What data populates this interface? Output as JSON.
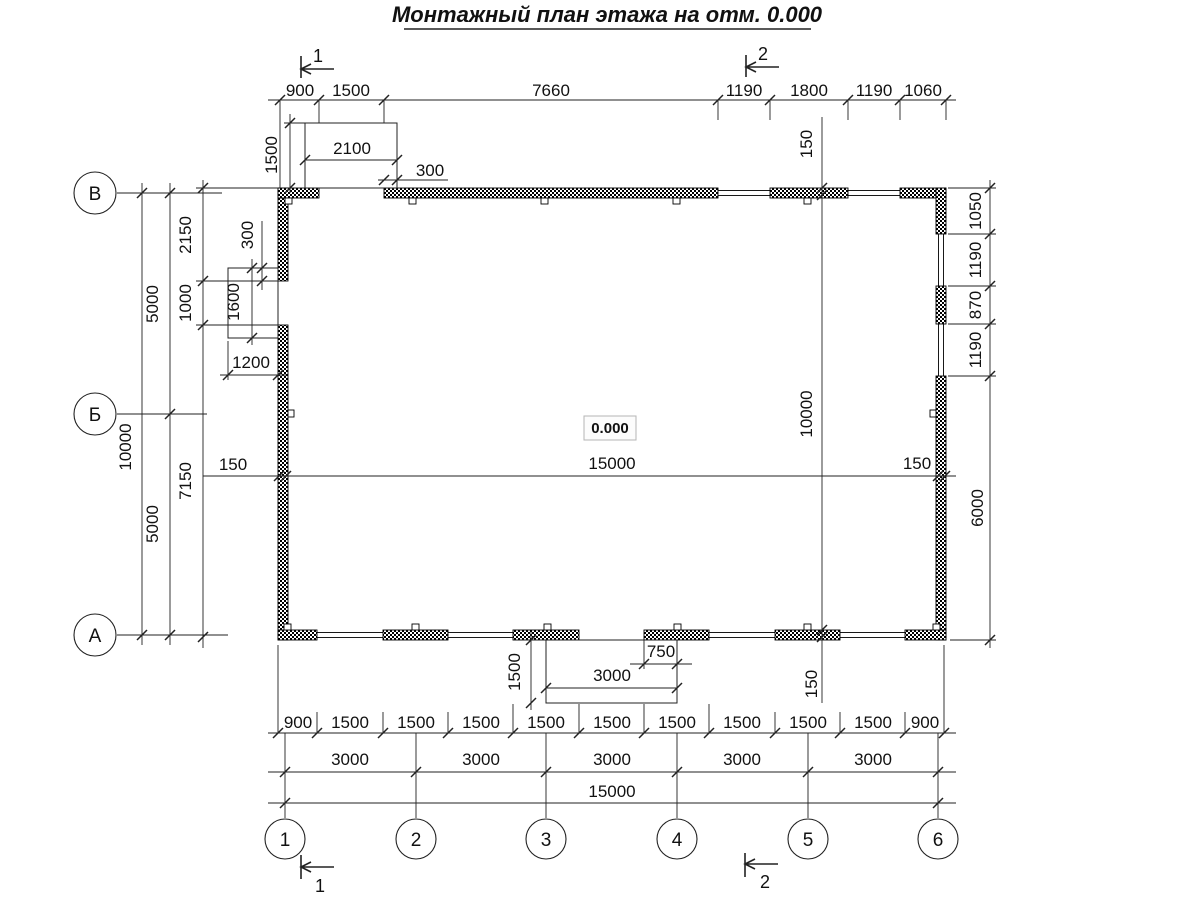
{
  "title": "Монтажный план этажа на отм. 0.000",
  "elevation_mark": "0.000",
  "axes": {
    "left": [
      "В",
      "Б",
      "А"
    ],
    "bottom": [
      "1",
      "2",
      "3",
      "4",
      "5",
      "6"
    ]
  },
  "section_marks": {
    "m1": "1",
    "m2": "2"
  },
  "dims": {
    "top": [
      "900",
      "1500",
      "7660",
      "1190",
      "1800",
      "1190",
      "1060"
    ],
    "top_porch": [
      "2100",
      "1500",
      "300"
    ],
    "left": [
      "10000",
      "5000",
      "5000",
      "2150",
      "1000",
      "7150"
    ],
    "left_porch": [
      "300",
      "1600",
      "1200"
    ],
    "mid_h": [
      "150",
      "15000",
      "150"
    ],
    "mid_v": [
      "150",
      "10000",
      "150"
    ],
    "right": [
      "1050",
      "1190",
      "870",
      "1190",
      "6000"
    ],
    "bottom_porch": [
      "1500",
      "750",
      "3000"
    ],
    "row1": [
      "900",
      "1500",
      "1500",
      "1500",
      "1500",
      "1500",
      "1500",
      "1500",
      "1500",
      "1500",
      "900"
    ],
    "row2": [
      "3000",
      "3000",
      "3000",
      "3000",
      "3000"
    ],
    "row3": [
      "15000"
    ]
  }
}
